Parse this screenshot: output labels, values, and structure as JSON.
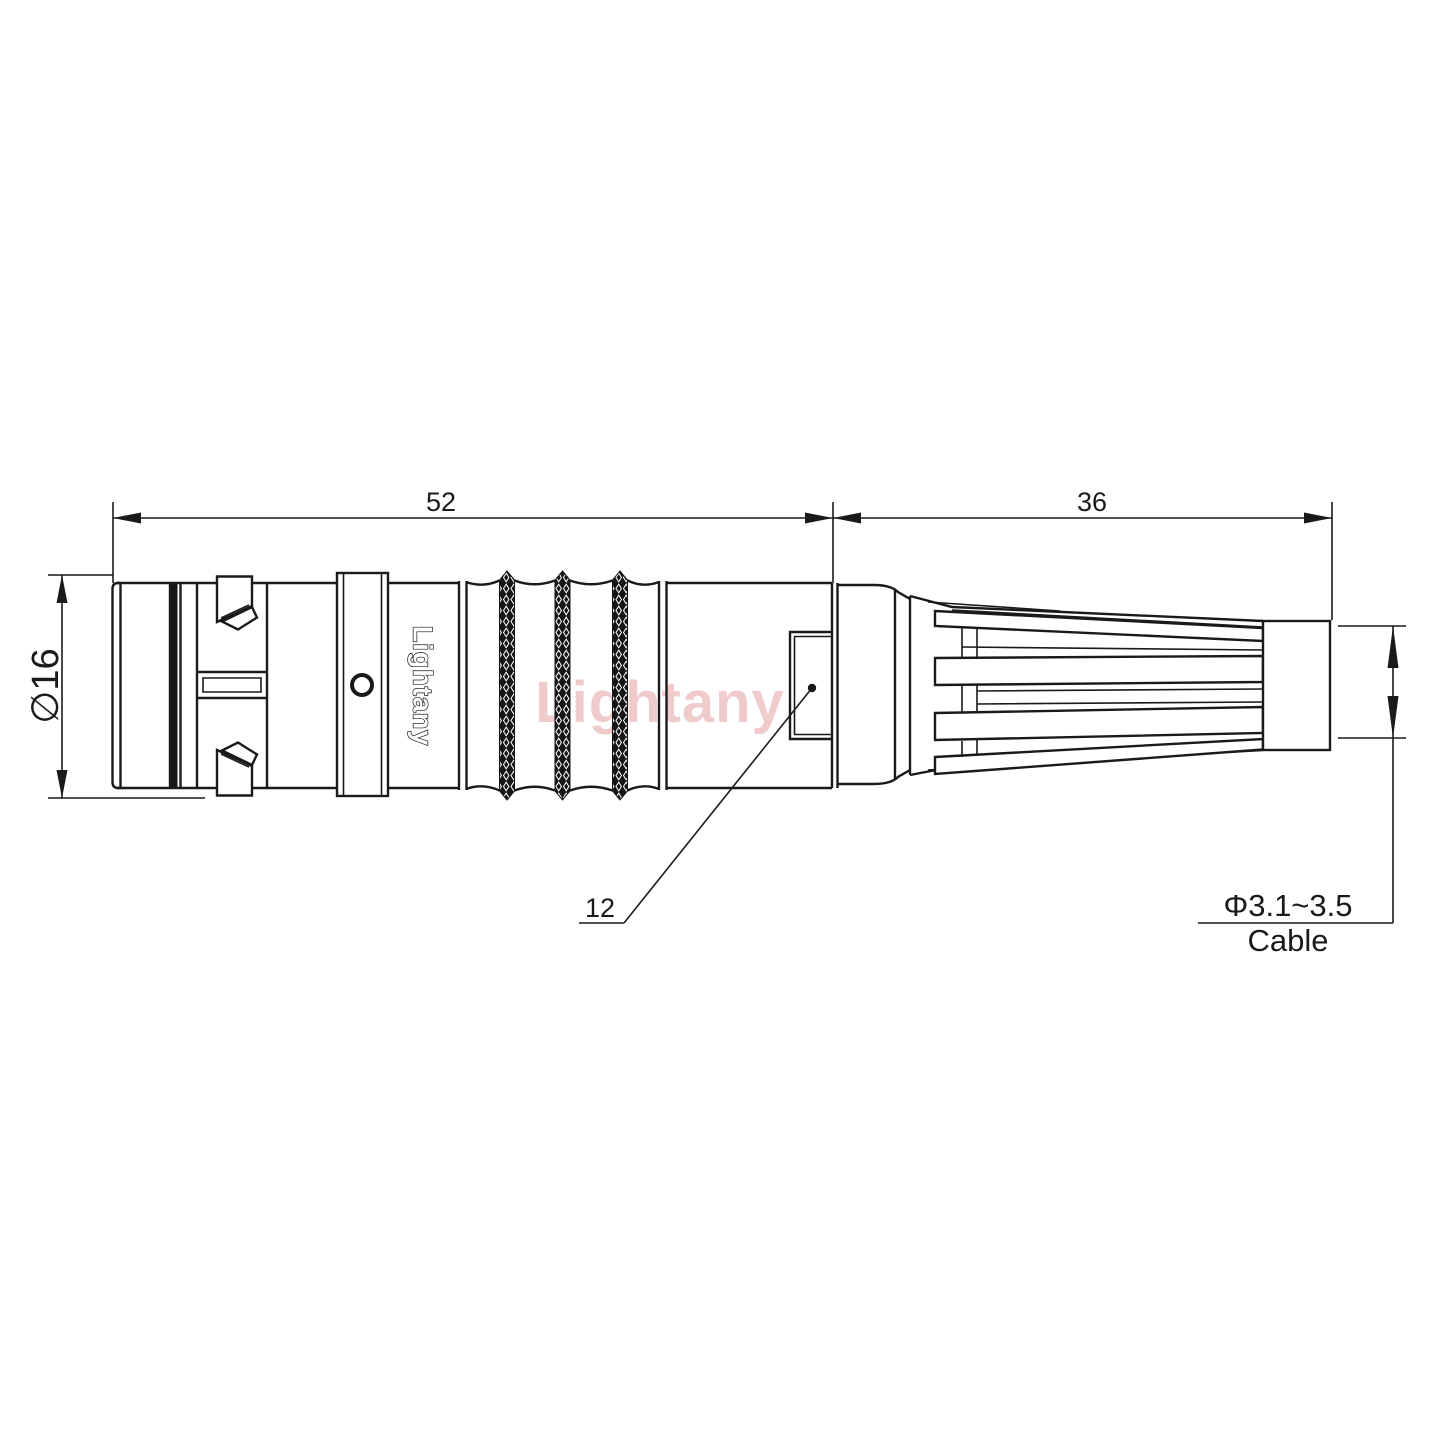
{
  "drawing": {
    "watermark": "Lightany",
    "body_brand": "Lightany",
    "dimensions": {
      "front_length": "52",
      "back_length": "36",
      "outer_diameter": "∅16",
      "window_size": "12",
      "cable_diameter": "Φ3.1~3.5",
      "cable_label": "Cable"
    },
    "colors": {
      "line": "#1a1a1a",
      "watermark_pink": "#d67878",
      "background": "#ffffff"
    }
  }
}
